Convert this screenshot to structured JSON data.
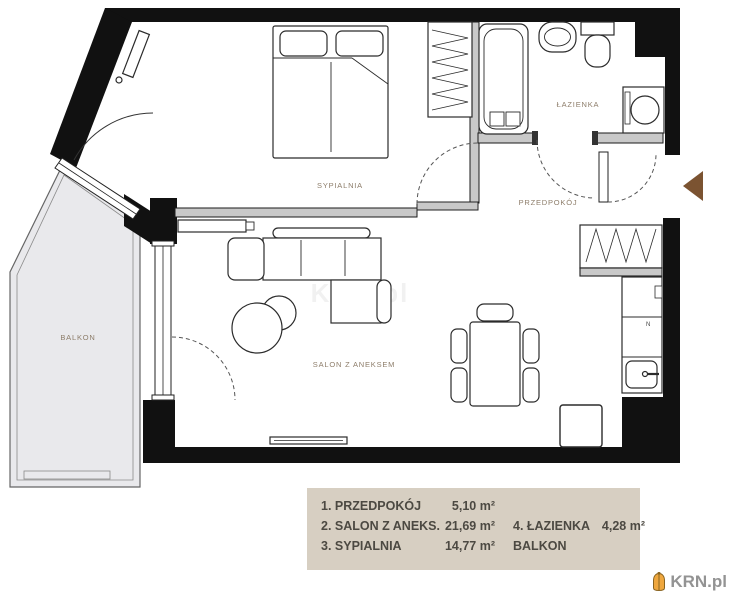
{
  "plan": {
    "room_labels": {
      "sypialnia": "SYPIALNIA",
      "salon": "SALON Z ANEKSEM",
      "przedpokoj": "PRZEDPOKÓJ",
      "lazienka": "ŁAZIENKA",
      "balkon": "BALKON"
    },
    "kitchen_mark": "N"
  },
  "legend": {
    "items": [
      {
        "label": "1. PRZEDPOKÓJ",
        "area": "5,10 m²"
      },
      {
        "label": "2. SALON Z ANEKS.",
        "area": "21,69 m²"
      },
      {
        "label": "3. SYPIALNIA",
        "area": "14,77 m²"
      },
      {
        "label": "4. ŁAZIENKA",
        "area": "4,28 m²"
      },
      {
        "label": "BALKON",
        "area": ""
      }
    ]
  },
  "watermark": {
    "brand": "KRN.pl"
  },
  "colors": {
    "wall": "#111111",
    "partition": "#c9c9c9",
    "balcony_fill": "#e9e9ec",
    "legend_bg": "#d7cfc2",
    "legend_text": "#4c4942",
    "room_label": "#8d7d6a",
    "entrance_arrow": "#7b5331",
    "brand_text": "#939393",
    "brand_icon": "#efa73e"
  }
}
